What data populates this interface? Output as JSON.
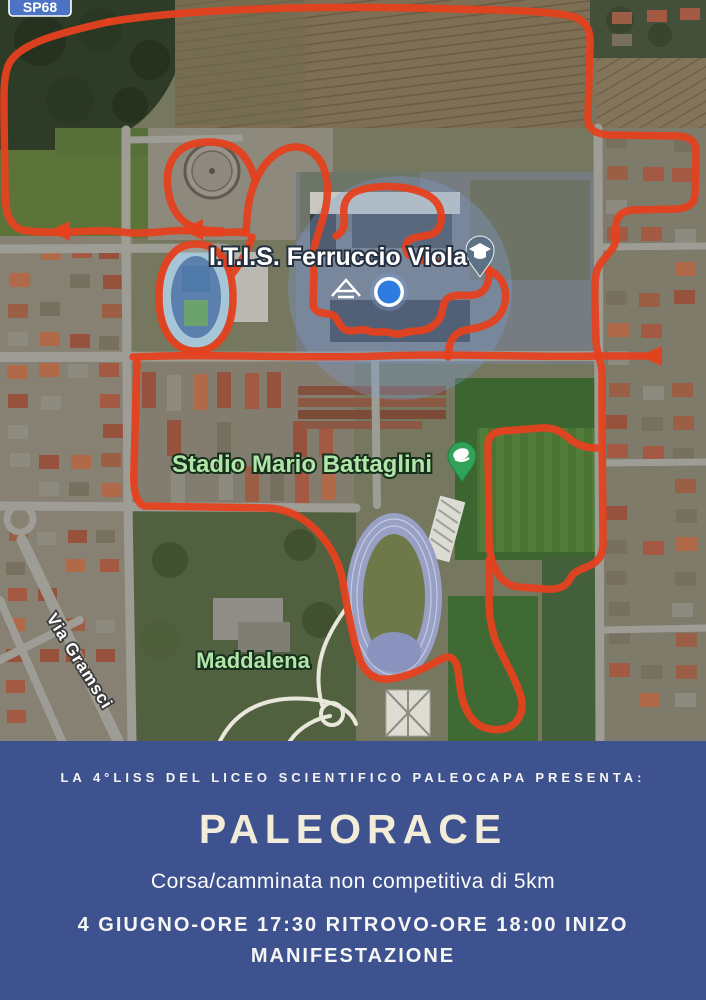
{
  "map": {
    "road_badge": "SP68",
    "labels": {
      "school": "I.T.I.S. Ferruccio Viola",
      "stadium": "Stadio Mario Battaglini",
      "neighborhood": "Maddalena",
      "street": "Via Gramsci"
    },
    "markers": {
      "school_pin": "graduation-cap-pin",
      "stadium_pin": "stadium-pin",
      "location_dot": "current-location-dot"
    },
    "route_color": "#e5411f"
  },
  "banner": {
    "background": "#3e5290",
    "presenter_line": "LA 4°LISS DEL LICEO SCIENTIFICO PALEOCAPA PRESENTA:",
    "title": "PALEORACE",
    "title_color": "#f2ecd8",
    "subtitle": "Corsa/camminata non competitiva di 5km",
    "schedule_line_1": "4 GIUGNO-ORE 17:30 RITROVO-ORE 18:00 INIZO",
    "schedule_line_2": "MANIFESTAZIONE"
  }
}
